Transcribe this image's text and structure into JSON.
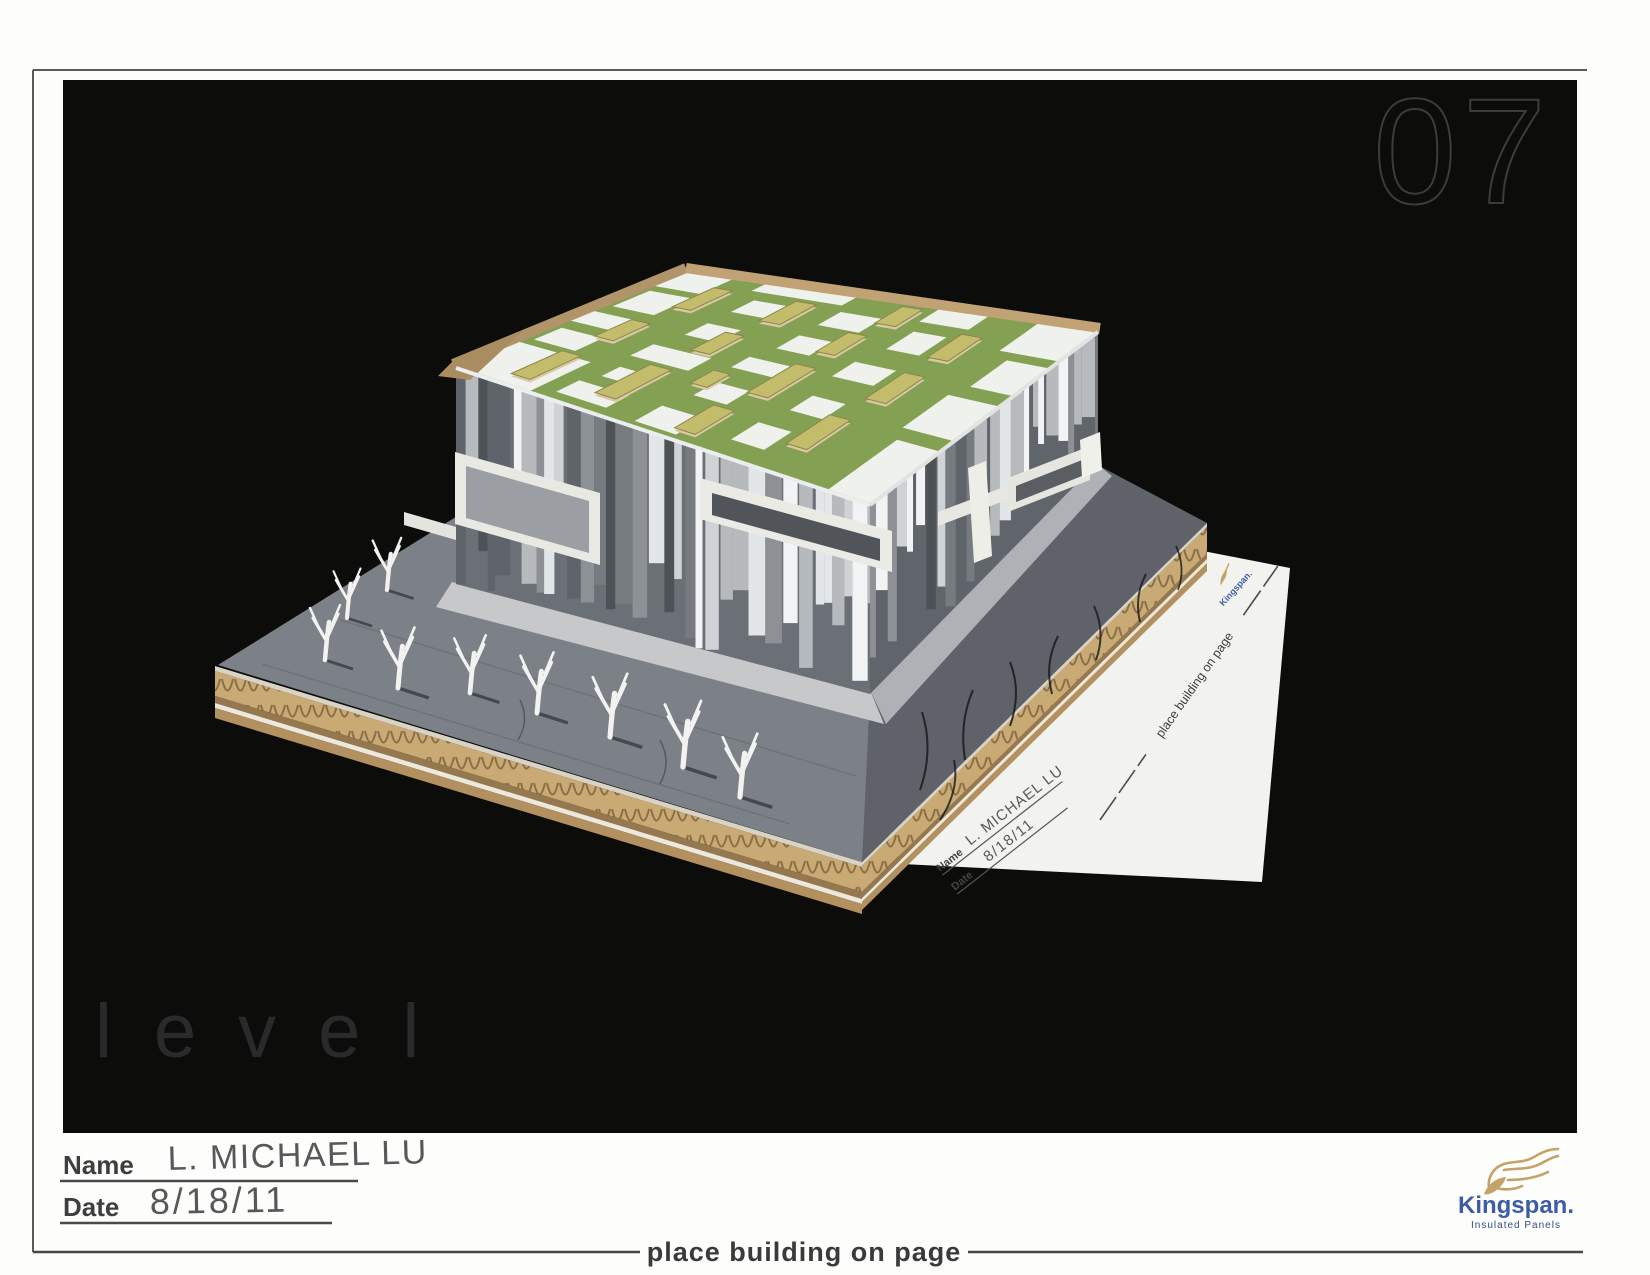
{
  "page": {
    "photo_number": "07",
    "watermark": "level",
    "footer_instruction": "place building on page"
  },
  "form": {
    "name_label": "Name",
    "name_value": "L. MICHAEL LU",
    "date_label": "Date",
    "date_value": "8/18/11"
  },
  "brand": {
    "name": "Kingspan.",
    "tagline": "Insulated Panels"
  },
  "colors": {
    "kingspan_blue": "#3d5ba6",
    "kingspan_tagline_blue": "#334f80",
    "lion_gold": "#c3a368",
    "photo_background": "#0c0c0b",
    "roof_green": "#84a153",
    "slate_gray": "#7c8188",
    "slate_dark": "#5f6369",
    "cardboard_tan": "#c9aa74",
    "tree_white": "#f2f3f1",
    "frame_line": "#585858"
  }
}
